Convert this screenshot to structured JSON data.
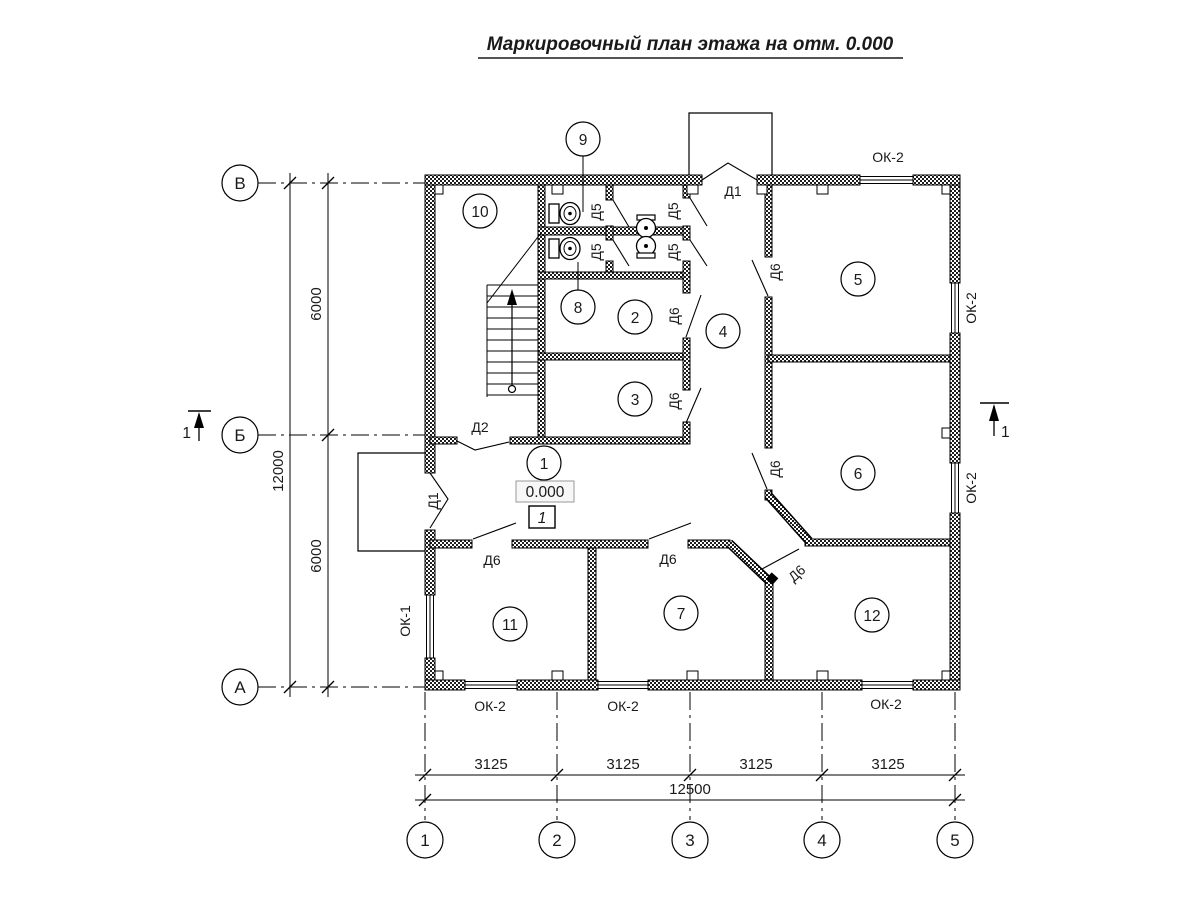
{
  "title": "Маркировочный план этажа на отм. 0.000",
  "grid": {
    "rows": [
      {
        "label": "В"
      },
      {
        "label": "Б"
      },
      {
        "label": "А"
      }
    ],
    "cols": [
      {
        "label": "1"
      },
      {
        "label": "2"
      },
      {
        "label": "3"
      },
      {
        "label": "4"
      },
      {
        "label": "5"
      }
    ]
  },
  "dimensions": {
    "col_spans": [
      "3125",
      "3125",
      "3125",
      "3125"
    ],
    "col_total": "12500",
    "row_spans": [
      "6000",
      "6000"
    ],
    "row_total": "12000"
  },
  "section_marks": {
    "left": "1",
    "right": "1"
  },
  "elevation": {
    "value": "0.000",
    "floor_type_mark": "1"
  },
  "rooms": {
    "r1": "1",
    "r2": "2",
    "r3": "3",
    "r4": "4",
    "r5": "5",
    "r6": "6",
    "r7": "7",
    "r8": "8",
    "r9": "9",
    "r10": "10",
    "r11": "11",
    "r12": "12"
  },
  "door_marks": {
    "d1_top": "Д1",
    "d1_left": "Д1",
    "d2": "Д2",
    "d5_stall_upper": "Д5",
    "d5_vest_upper": "Д5",
    "d5_stall_lower": "Д5",
    "d5_vest_lower": "Д5",
    "d6_room2": "Д6",
    "d6_room3": "Д6",
    "d6_corridor": "Д6",
    "d6_room6": "Д6",
    "d6_room11": "Д6",
    "d6_room7": "Д6",
    "d6_room12": "Д6"
  },
  "window_marks": {
    "ok2_top": "ОК-2",
    "ok2_right_upper": "ОК-2",
    "ok2_right_lower": "ОК-2",
    "ok1_left": "ОК-1",
    "ok2_bottom_left": "ОК-2",
    "ok2_bottom_center": "ОК-2",
    "ok2_bottom_right": "ОК-2"
  }
}
